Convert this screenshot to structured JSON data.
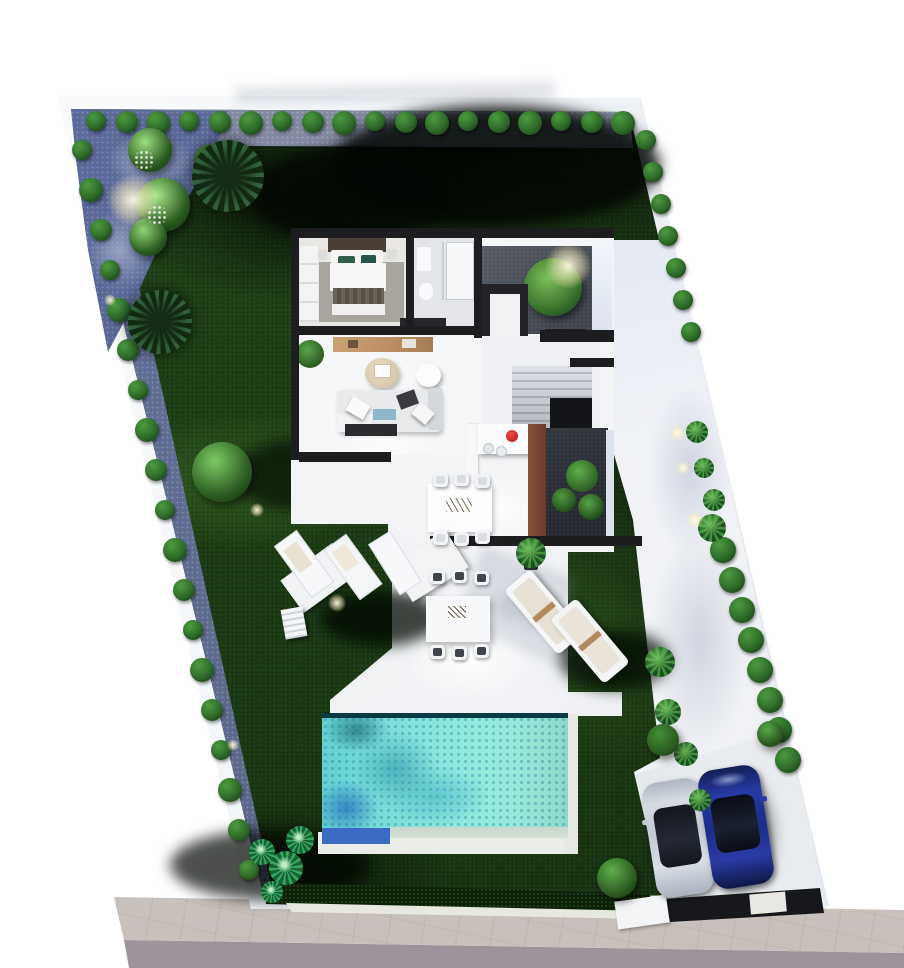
{
  "meta": {
    "description": "3D top-down architectural render of a villa plot: walled parallelogram garden with perimeter hedges, single-storey house floor plan, white terraces, turquoise pool, side walkway, driveway with two parked cars, sidewalk and street",
    "visible_text": "none"
  },
  "palette": {
    "bg": "#ffffff",
    "road": "#a59aa2",
    "sidewalk": "#cdc5c0",
    "wall-white": "#f7f9fb",
    "lawn": "#1e3e16",
    "lawn-dark": "#081505",
    "gravel-blue": "#5e6c9b",
    "gravel-light": "#a9b2ca",
    "gravel-top": "#7b8197",
    "bush": "#2f6b2a",
    "bush-dark": "#1b4017",
    "bush-light": "#4c9a3f",
    "tree-light": "#8ed573",
    "house-wall": "#1d1d20",
    "floor": "#eef0f2",
    "floor-bright": "#f7f8f9",
    "rug": "#a8a49e",
    "patio-gravel": "#4b5058",
    "wood": "#b98e63",
    "planter-brown": "#7c4a38",
    "teal-pillow": "#2e5f4a",
    "east-band": "#ccd6ea",
    "terrace": "#f4f5f7",
    "pool-water": "#87e3d9",
    "pool-deep": "#3a9db4",
    "pool-blue": "#3b6ac2",
    "coping": "#ebeee8",
    "pad": "#d5d9de",
    "car-silver": "#ccd2da",
    "car-blue": "#203093",
    "glass": "#0f1218",
    "red-accent": "#cf1f1f",
    "throw-blue": "#8fb6c9"
  },
  "garden": {
    "bushes_top": {
      "count": 18,
      "label": "clipped boundary shrub"
    },
    "bushes_left": {
      "count": 19,
      "label": "clipped boundary shrub"
    },
    "bushes_right": {
      "count": 7,
      "label": "clipped boundary shrub"
    },
    "hedge_bumps_right": {
      "count": 8,
      "label": "hedge ball along walkway"
    },
    "walkway_plants": {
      "count": 8,
      "label": "leafy shrub"
    },
    "garden_lights": {
      "count": 9,
      "label": "garden spot light"
    },
    "light_trees": {
      "count": 7,
      "label": "ornamental tree"
    },
    "palm_trees": {
      "count": 2,
      "label": "palm tree"
    },
    "corner_plants": {
      "count": 3,
      "label": "tropical plant"
    }
  },
  "house": {
    "rooms": [
      "bedroom",
      "bathroom",
      "light patio",
      "living room",
      "entry hall",
      "staircase",
      "kitchen",
      "dining area",
      "inner court"
    ],
    "furniture": [
      "double bed",
      "wardrobe",
      "shower",
      "toilet",
      "sofa",
      "coffee tables",
      "media console",
      "kitchen island",
      "dining table with 6 chairs"
    ]
  },
  "exterior": {
    "pool": {
      "water": "#87e3d9",
      "deep_ripples": "#3a9db4",
      "blue_corner": "#3b6ac2",
      "coping": "#ebeee8"
    },
    "furniture": [
      "sun loungers left group (3 + stool)",
      "outdoor dining table with 6 chairs",
      "two padded loungers right",
      "potted plant"
    ],
    "cars": [
      {
        "name": "silver-car",
        "body": "#ccd2da",
        "glass": "#0f1218"
      },
      {
        "name": "blue-car",
        "body": "#203093",
        "glass": "#0a0d14"
      }
    ]
  }
}
